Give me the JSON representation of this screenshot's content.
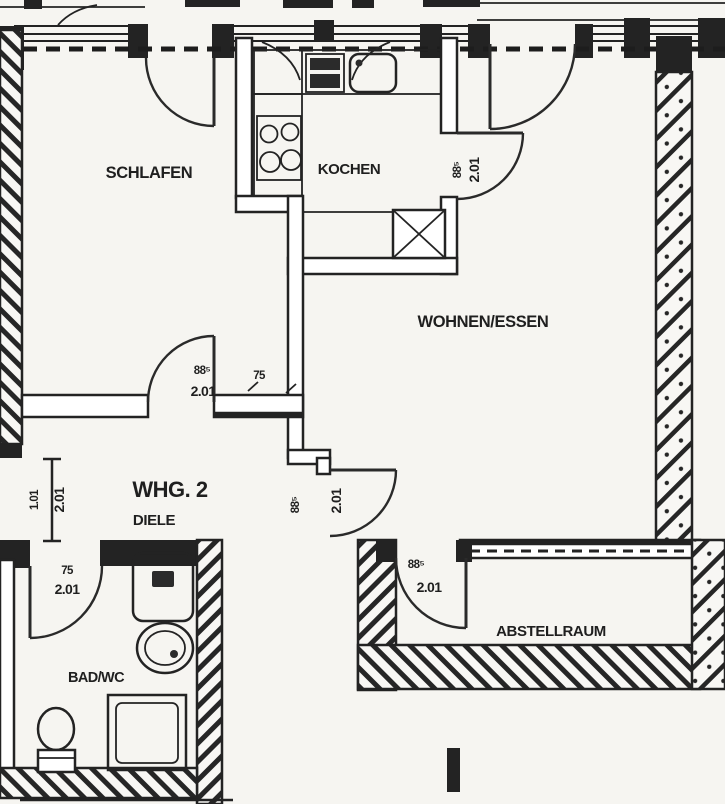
{
  "colors": {
    "ink": "#232323",
    "paper": "#f6f5f1"
  },
  "plan": {
    "apartment_label": "WHG. 2",
    "rooms": {
      "schlafen": "SCHLAFEN",
      "kochen": "KOCHEN",
      "wohnen": "WOHNEN/ESSEN",
      "diele": "DIELE",
      "bad": "BAD/WC",
      "abstellraum": "ABSTELLRAUM"
    },
    "doors": {
      "entrance": {
        "width": "1.01",
        "height": "2.01"
      },
      "bedroom": {
        "width": "88⁵",
        "height": "2.01"
      },
      "kitchen": {
        "width": "88⁵",
        "height": "2.01"
      },
      "living": {
        "width": "88⁵",
        "height": "2.01"
      },
      "bath": {
        "width": "75",
        "height": "2.01"
      },
      "storage": {
        "width": "88⁵",
        "height": "2.01"
      }
    },
    "dims": {
      "bedroom_wall_pier": "75"
    },
    "fixtures": {
      "kitchen": [
        "stove-icon",
        "sink-icon",
        "cooktop-icon",
        "service-shaft-icon"
      ],
      "bath": [
        "washing-machine-icon",
        "washbasin-icon",
        "shower-icon",
        "toilet-icon"
      ]
    }
  }
}
